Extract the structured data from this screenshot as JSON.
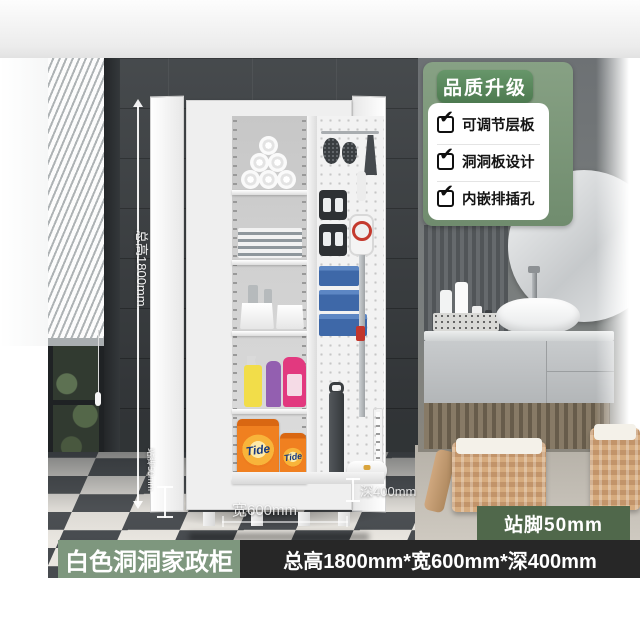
{
  "quality_card": {
    "header": "品质升级",
    "features": [
      "可调节层板",
      "洞洞板设计",
      "内嵌排插孔"
    ]
  },
  "dimension_labels": {
    "total_height": "总高1800mm",
    "stand_feet": "站脚50mm",
    "width": "宽600mm",
    "depth": "深400mm"
  },
  "stand_feet_badge": "站脚50mm",
  "bottom_banner": {
    "product_name": "白色洞洞家政柜",
    "specs": "总高1800mm*宽600mm*深400mm"
  },
  "cabinet_contents": {
    "detergent_brand": "Tide"
  },
  "icons": {
    "check": "✔"
  },
  "colors": {
    "quality_header_green": "#5d8a5e",
    "quality_panel_green": "#7d9678",
    "stand_feet_badge_green": "#50684b",
    "banner_green": "#7e977e",
    "banner_dark": "#272727",
    "wall_dark_gray": "#3b3f42",
    "tide_orange": "#f08020",
    "bin_blue": "#3e68a8",
    "detergent_magenta": "#e2397f"
  }
}
